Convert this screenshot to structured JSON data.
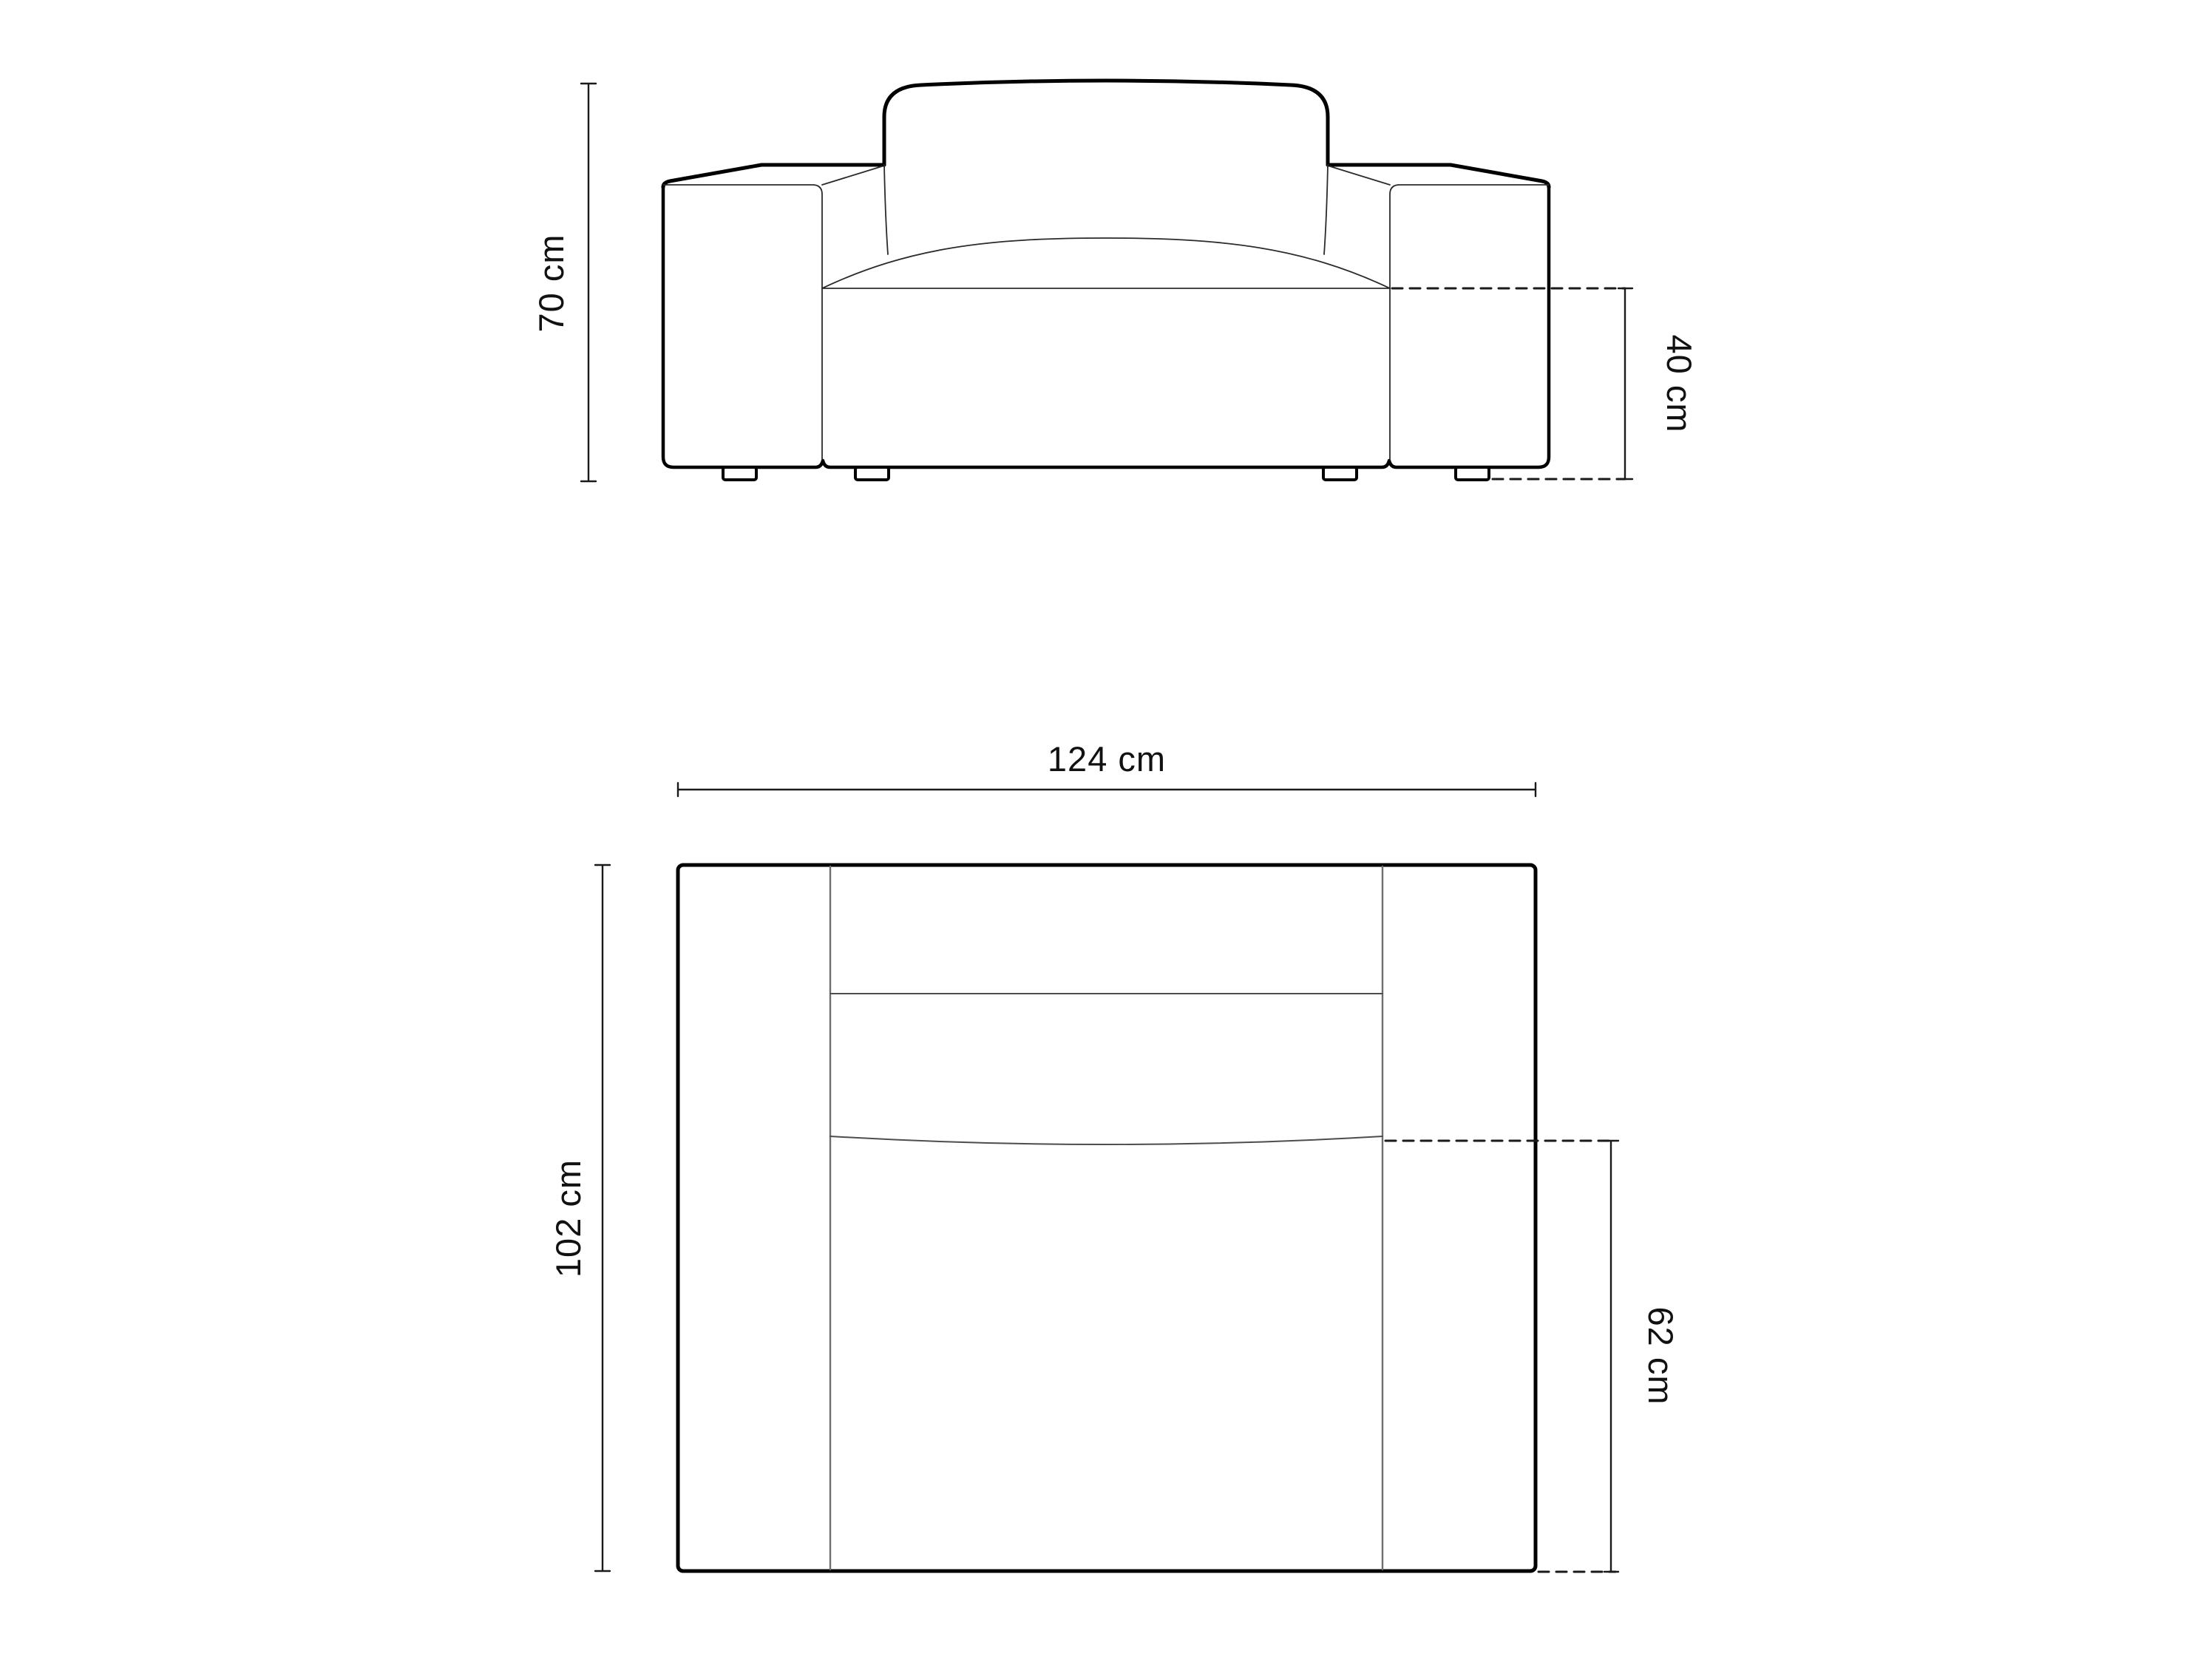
{
  "diagram": {
    "type": "furniture-technical-drawing",
    "subject": "armchair",
    "unit": "cm",
    "views": {
      "front": {
        "name": "front elevation view",
        "overall_height_label": "70 cm",
        "seat_height_label": "40 cm"
      },
      "top": {
        "name": "top plan view",
        "overall_width_label": "124 cm",
        "overall_depth_label": "102 cm",
        "seat_depth_label": "62 cm"
      }
    },
    "dimensions": {
      "height_cm": 70,
      "seat_height_cm": 40,
      "width_cm": 124,
      "depth_cm": 102,
      "seat_depth_cm": 62
    },
    "colors": {
      "outline": "#000000",
      "thin_line": "#2b2b2b",
      "inner_plan_line": "#6e6e6e",
      "inner_plan_soft_line": "#4d4d4d",
      "dashed_line": "#1a1a1a",
      "dimension_line": "#1a1a1a",
      "text": "#111111",
      "background": "#ffffff"
    }
  }
}
